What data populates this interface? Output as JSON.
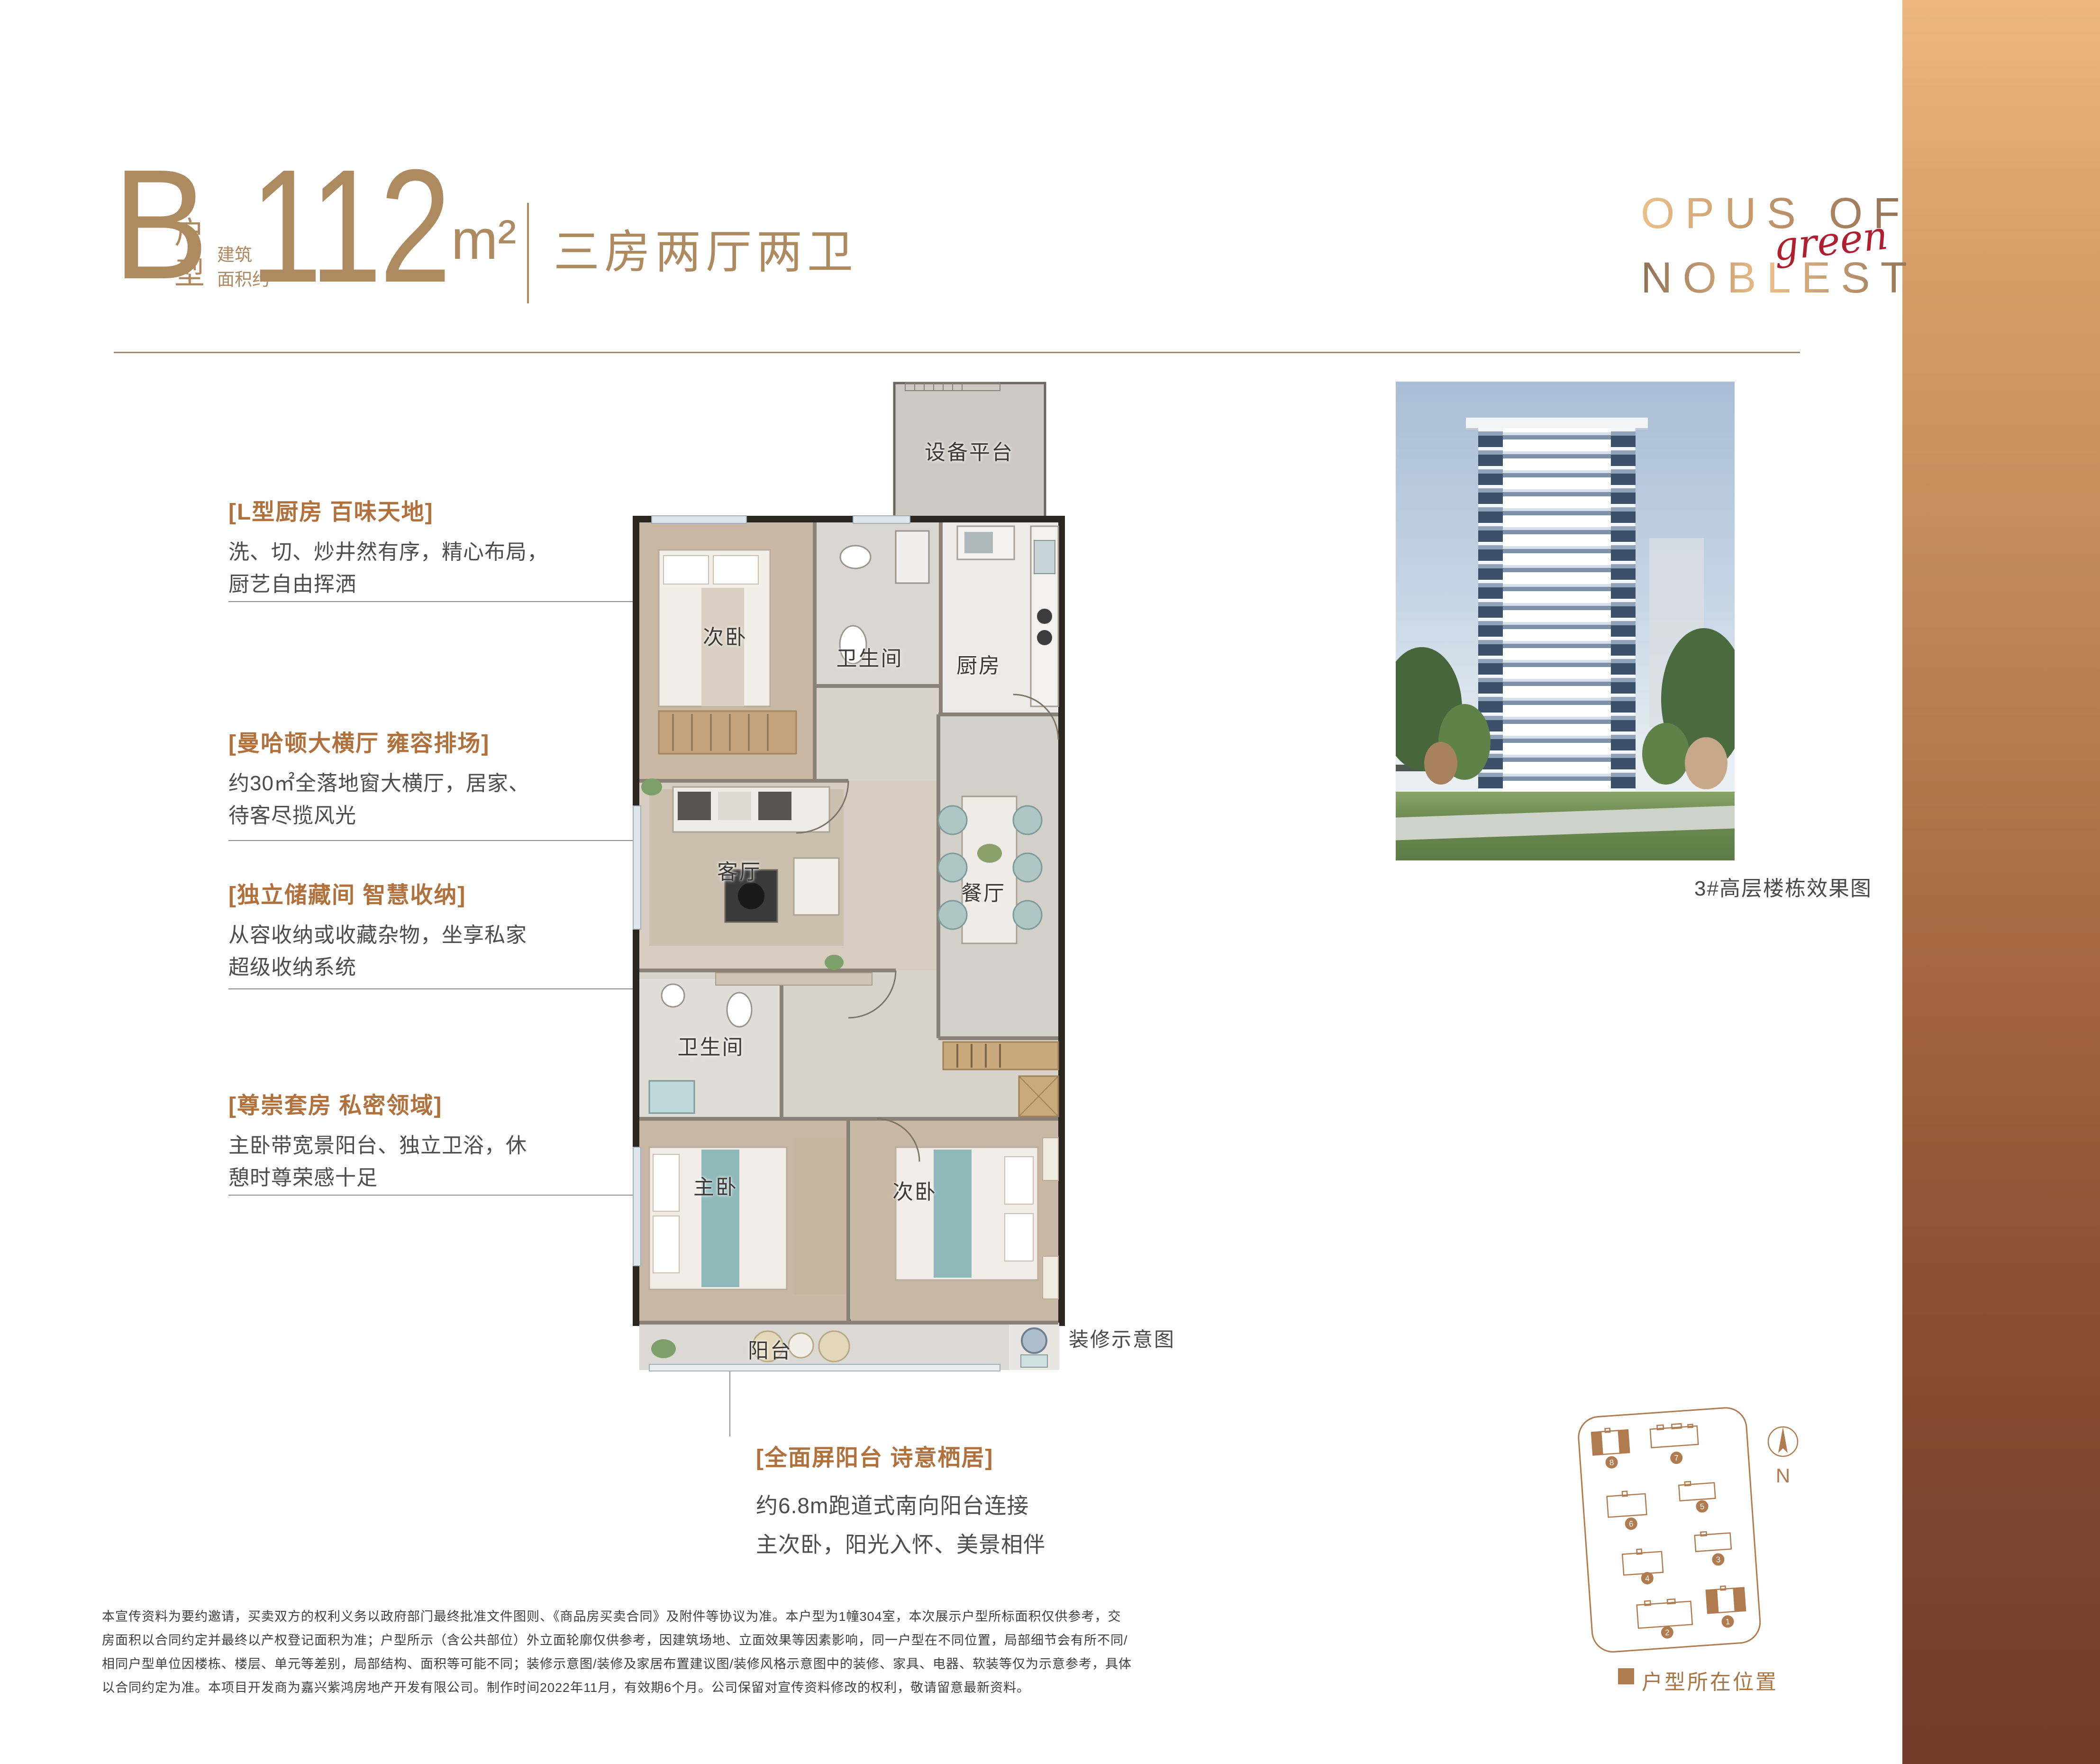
{
  "header": {
    "type_letter": "B",
    "type_suffix": "户型",
    "area_label_1": "建筑",
    "area_label_2": "面积约",
    "area_value": "112",
    "area_unit": "m²",
    "layout": "三房两厅两卫",
    "accent_color": "#ae8a60"
  },
  "logo": {
    "line1": "OPUS OF",
    "line2": "NOBLEST",
    "script": "green",
    "script_color": "#b01f2f"
  },
  "features": [
    {
      "heading": "[L型厨房 百味天地]",
      "line1": "洗、切、炒井然有序，精心布局，",
      "line2": "厨艺自由挥洒"
    },
    {
      "heading": "[曼哈顿大横厅 雍容排场]",
      "line1": "约30㎡全落地窗大横厅，居家、",
      "line2": "待客尽揽风光"
    },
    {
      "heading": "[独立储藏间 智慧收纳]",
      "line1": "从容收纳或收藏杂物，坐享私家",
      "line2": "超级收纳系统"
    },
    {
      "heading": "[尊崇套房 私密领域]",
      "line1": "主卧带宽景阳台、独立卫浴，休",
      "line2": "憩时尊荣感十足"
    }
  ],
  "balcony_feature": {
    "heading": "[全面屏阳台 诗意栖居]",
    "line1": "约6.8m跑道式南向阳台连接",
    "line2": "主次卧，阳光入怀、美景相伴"
  },
  "floorplan": {
    "rooms": [
      {
        "label": "设备平台"
      },
      {
        "label": "次卧"
      },
      {
        "label": "卫生间"
      },
      {
        "label": "厨房"
      },
      {
        "label": "客厅"
      },
      {
        "label": "餐厅"
      },
      {
        "label": "卫生间"
      },
      {
        "label": "主卧"
      },
      {
        "label": "次卧"
      },
      {
        "label": "阳台"
      }
    ],
    "caption": "装修示意图",
    "feature_color": "#b1713d"
  },
  "render": {
    "caption": "3#高层楼栋效果图"
  },
  "siteplan": {
    "north": "N",
    "legend": "户型所在位置",
    "brand_color": "#b07b4f",
    "buildings": [
      {
        "num": "1"
      },
      {
        "num": "2"
      },
      {
        "num": "3"
      },
      {
        "num": "4"
      },
      {
        "num": "5"
      },
      {
        "num": "6"
      },
      {
        "num": "7"
      },
      {
        "num": "8"
      }
    ]
  },
  "disclaimer": {
    "lines": [
      "本宣传资料为要约邀请，买卖双方的权利义务以政府部门最终批准文件图则、《商品房买卖合同》及附件等协议为准。本户型为1幢304室，本次展示户型所标面积仅供参考，交",
      "房面积以合同约定并最终以产权登记面积为准；户型所示（含公共部位）外立面轮廓仅供参考，因建筑场地、立面效果等因素影响，同一户型在不同位置，局部细节会有所不同/",
      "相同户型单位因楼栋、楼层、单元等差别，局部结构、面积等可能不同；装修示意图/装修及家居布置建议图/装修风格示意图中的装修、家具、电器、软装等仅为示意参考，具体",
      "以合同约定为准。本项目开发商为嘉兴紫鸿房地产开发有限公司。制作时间2022年11月，有效期6个月。公司保留对宣传资料修改的权利，敬请留意最新资料。"
    ]
  }
}
